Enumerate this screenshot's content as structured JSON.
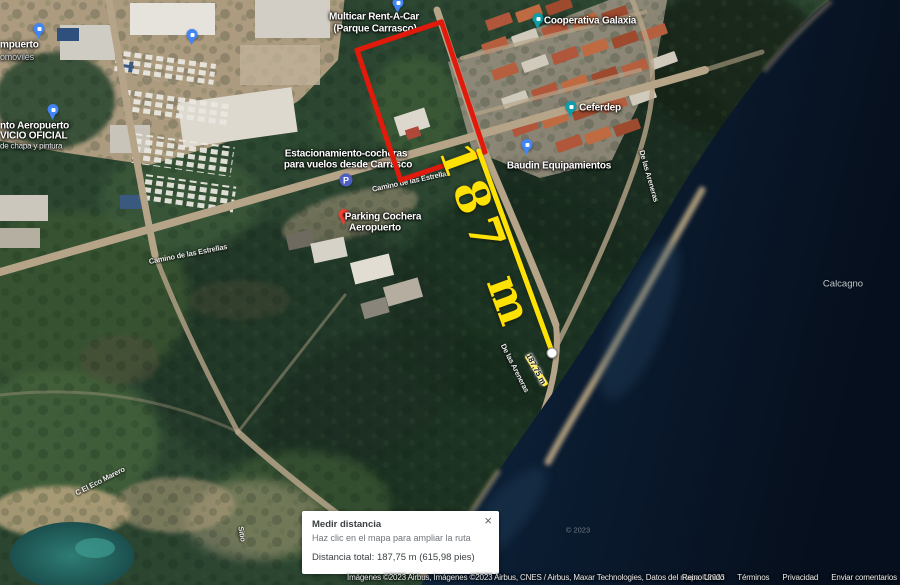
{
  "map": {
    "pois": {
      "multicar": {
        "line1": "Multicar Rent-A-Car",
        "line2": "(Parque Carrasco)"
      },
      "cooperativa": {
        "label": "Cooperativa Galaxia"
      },
      "ceferdep": {
        "label": "Ceferdep"
      },
      "baudin": {
        "label": "Baudin Equipamientos"
      },
      "estacionamiento": {
        "line1": "Estacionamiento-cocheras",
        "line2": "para vuelos desde Carrasco"
      },
      "parking": {
        "line1": "Parking Cochera",
        "line2": "Aeropuerto"
      },
      "servicio": {
        "line1": "nto Aeropuerto",
        "line2": "VICIO OFICIAL",
        "line3": "de chapa y pintura"
      },
      "airport": {
        "line1": "mpuerto",
        "line2": "omóviles"
      }
    },
    "streets": {
      "estrellas": "Camino de las Estrellas",
      "estrellas2": "Camino de las Estrellas",
      "areneras": "De las Areneras",
      "areneras2": "De las Areneras",
      "sitio": "Sitio",
      "marero": "C El Eco Marero"
    },
    "areas": {
      "calcagno": "Calcagno"
    },
    "watermark": "© 2023"
  },
  "icons": {
    "parking_glyph": "P"
  },
  "measurement": {
    "big_label": "187 m",
    "segment_label": "187,75 m"
  },
  "popup": {
    "title": "Medir distancia",
    "subtitle": "Haz clic en el mapa para ampliar la ruta",
    "total": "Distancia total: 187,75 m (615,98 pies)",
    "close_icon": "×"
  },
  "attribution": {
    "imagery": "Imágenes ©2023 Airbus, Imágenes ©2023 Airbus, CNES / Airbus, Maxar Technologies, Datos del mapa ©2023",
    "links": [
      "Reino Unido",
      "Términos",
      "Privacidad",
      "Enviar comentarios"
    ]
  },
  "colors": {
    "annotation_red": "#e11a0c",
    "annotation_yellow": "#ffe205"
  }
}
